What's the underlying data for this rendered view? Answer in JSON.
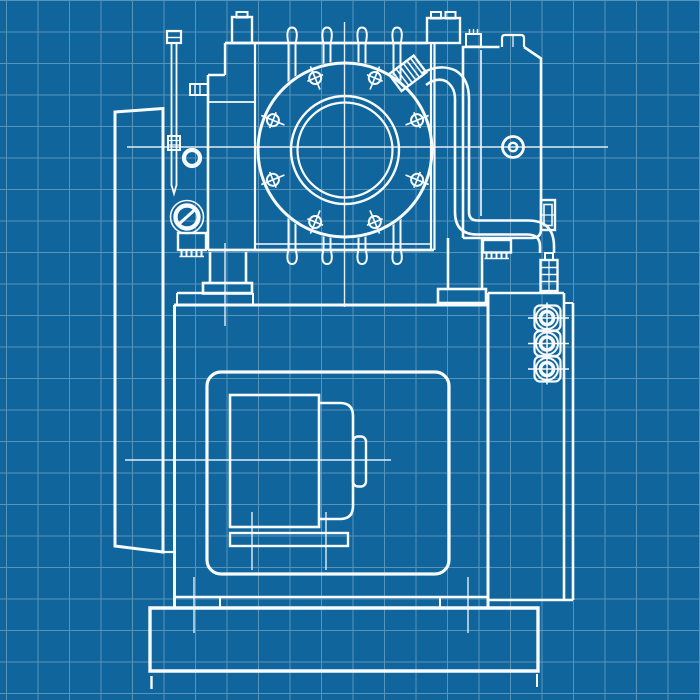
{
  "meta": {
    "drawing_kind": "technical-blueprint",
    "visible_text": ""
  },
  "canvas": {
    "width": 700,
    "height": 700
  },
  "colors": {
    "background": "#0F659C",
    "grid": "rgba(255,255,255,0.30)",
    "line": "#F8FBFD"
  },
  "grid": {
    "spacing": 31.5,
    "offset_x": 6,
    "offset_y": 0
  },
  "flange": {
    "cx": 345,
    "cy": 150,
    "outer_r": 87,
    "mid_r": 54,
    "inner_r": 47.5,
    "bolt_circle_r": 78,
    "bolt_count": 8
  },
  "sight_glasses": {
    "x": 547,
    "ys": [
      318,
      343.5,
      369
    ]
  },
  "parts": {
    "blower_body": "roots-blower-housing",
    "cooling_fins": "cooling-fins",
    "flange": "front-discharge-flange",
    "gear_housing": "left-gear-housing",
    "dipstick": "oil-dipstick",
    "oil_ring": "oil-filler-ring",
    "oil_glass": "oil-level-sight-glass",
    "belt_cover": "right-belt-guard-cover",
    "pipe": "lubrication-pipe",
    "tank": "base-tank",
    "window": "motor-inspection-window",
    "motor": "electric-motor",
    "base": "foundation-base-plate",
    "glass_trio": "tank-sight-glass-column"
  }
}
